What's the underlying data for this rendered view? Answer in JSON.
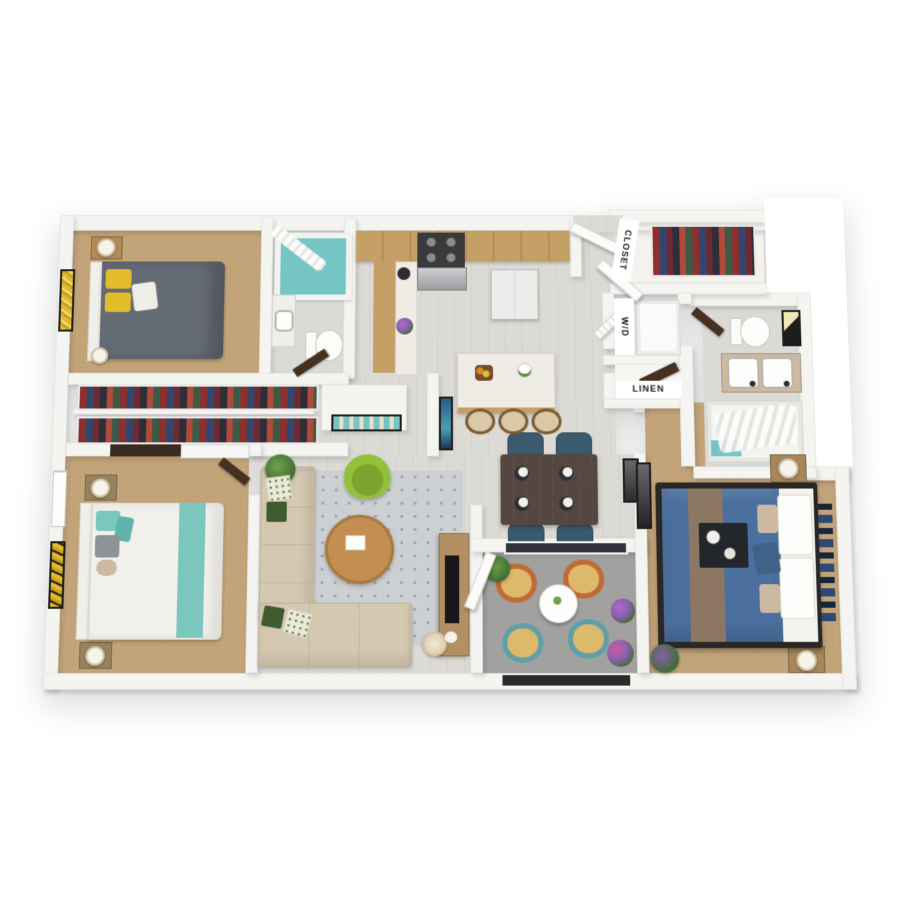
{
  "labels": {
    "walk_in_closet": "CLOSET",
    "washer_dryer": "W/D",
    "linen_closet": "LINEN"
  },
  "palette": {
    "wall": "#f4f4f1",
    "wood_floor": "#dcdad5",
    "carpet": "#c2a378",
    "tile": "#dadad7",
    "patio": "#a1a19f",
    "rug": "#cdd0d2",
    "door": "#46301f",
    "cabinet_wood": "#c49f66",
    "counter_white": "#efece6",
    "accent_teal": "#74c5c3",
    "bed_gray": "#656b74",
    "bed_white": "#f2f0ea",
    "teal_runner": "#7cc7bd",
    "master_blue": "#4b6f9e",
    "runner_brown": "#8c7763",
    "sofa_beige": "#d5c8b1",
    "chair_green": "#93c03a",
    "coffee_table": "#c28f51",
    "dining_table": "#544740",
    "dining_chair": "#3b5a6e",
    "pillow_yellow": "#e3bc2a",
    "patio_cushion": "#ddb96c",
    "patio_ring_orange": "#c06a35",
    "patio_ring_teal": "#5f9fa8",
    "plant_green": "#3f6e33"
  },
  "rooms": [
    "bedroom-top-left",
    "hall-bathroom",
    "kitchen",
    "entry",
    "walk-in-closet",
    "washer-dryer-closet",
    "linen-closet",
    "main-bathroom",
    "hallway-closets",
    "bedroom-bottom-left",
    "living-room",
    "dining-area",
    "patio",
    "master-bedroom"
  ]
}
